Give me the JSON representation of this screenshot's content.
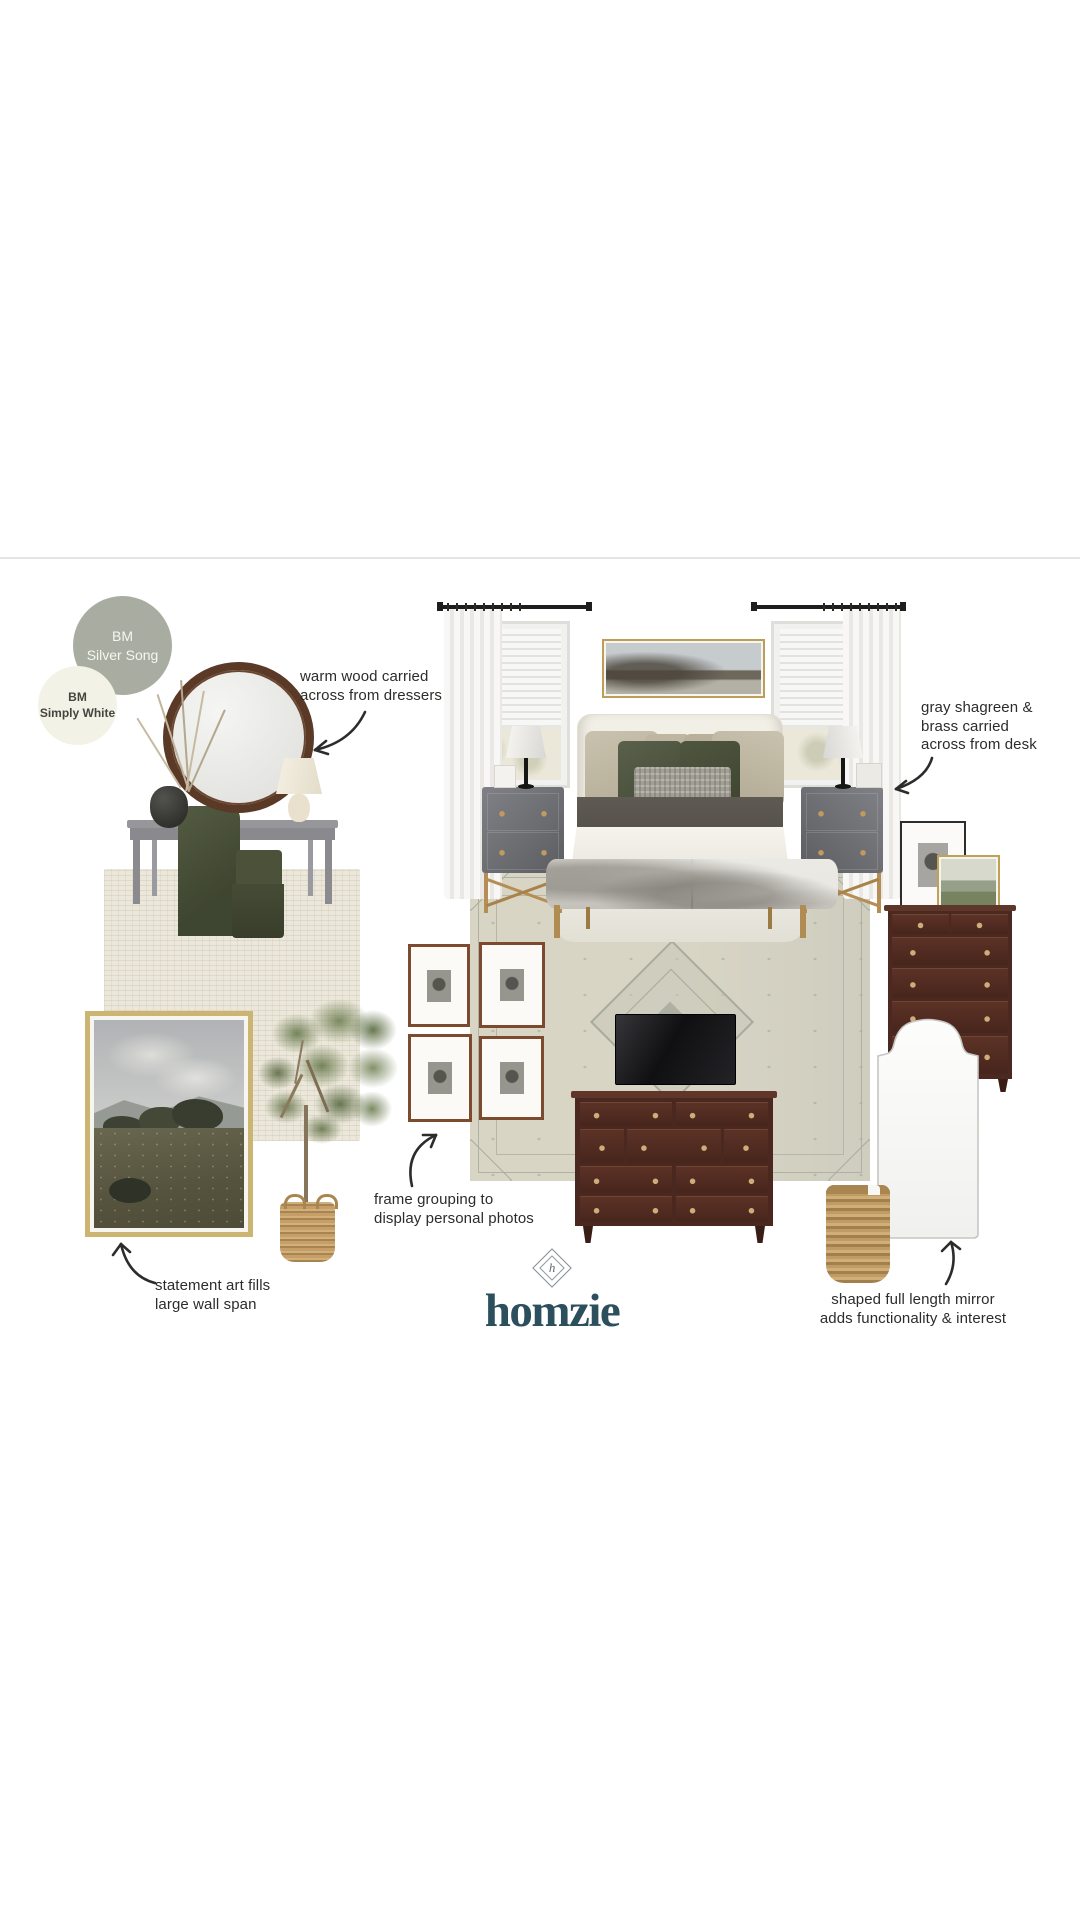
{
  "board_title": "bedroom design mood board",
  "swatches": [
    {
      "label": "BM\nSilver Song",
      "bg": "#a9ada1",
      "fg": "#f6f6f0"
    },
    {
      "label": "BM\nSimply White",
      "bg": "#f3f2e6",
      "fg": "#45453f"
    }
  ],
  "annotations": [
    {
      "id": "warm-wood",
      "text": "warm wood carried\nacross from dressers"
    },
    {
      "id": "shagreen",
      "text": "gray shagreen &\nbrass carried\nacross from desk"
    },
    {
      "id": "frame-grouping",
      "text": "frame grouping to\ndisplay personal photos"
    },
    {
      "id": "statement-art",
      "text": "statement art fills\nlarge wall span"
    },
    {
      "id": "shaped-mirror",
      "text": "shaped full length mirror\nadds functionality & interest"
    }
  ],
  "logo": {
    "wordmark": "homzie",
    "monogram": "h",
    "color": "#2c4f5d"
  },
  "icons": [
    {
      "name": "curved-arrow",
      "shape": "hand-drawn curved arrow"
    },
    {
      "name": "diamond-monogram",
      "shape": "rotated square with inner h monogram"
    }
  ],
  "palette": {
    "silver_song": "#a9ada1",
    "simply_white": "#f3f2e6",
    "brand_teal": "#2c4f5d",
    "annotation_text": "#2c2c2a",
    "warm_wood": "#5a3a27",
    "mahogany": "#4b2921",
    "brass": "#b58e55",
    "olive_velvet": "#4a503a",
    "rug_beige": "#d8d5c5"
  }
}
